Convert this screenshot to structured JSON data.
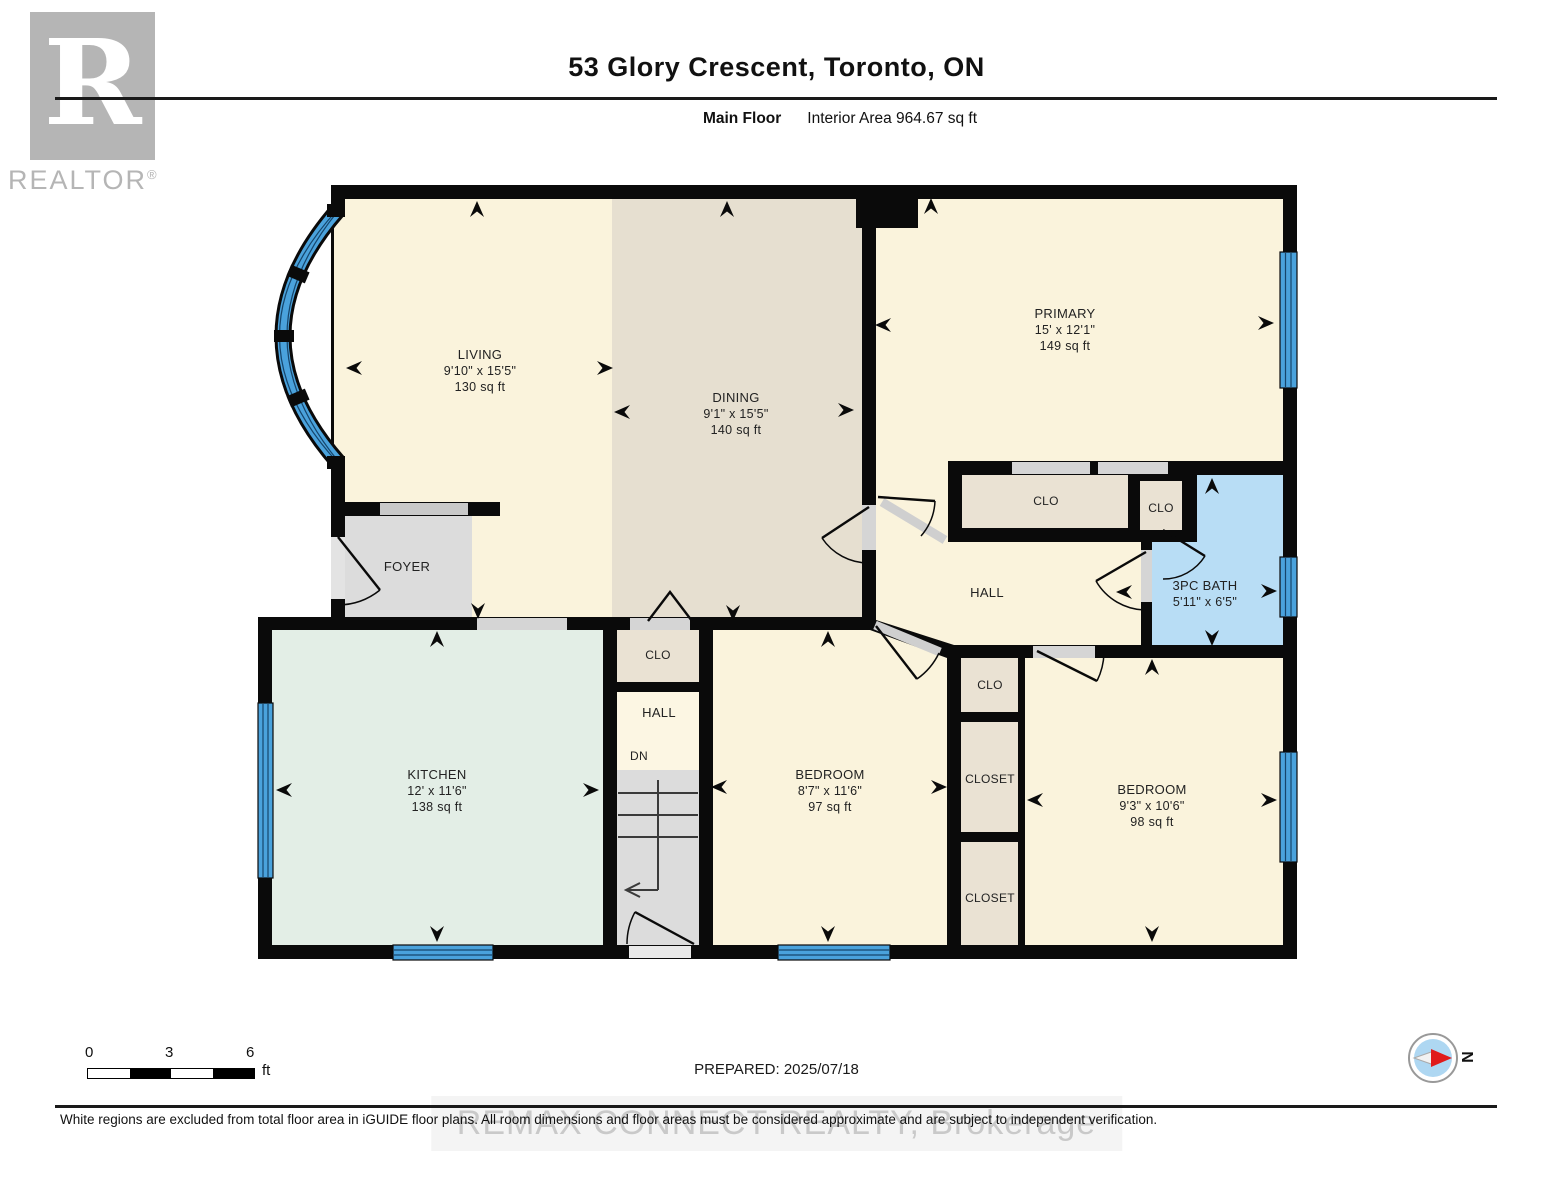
{
  "header": {
    "title": "53 Glory Crescent, Toronto, ON",
    "floor_label": "Main Floor",
    "area_label": "Interior Area 964.67 sq ft"
  },
  "branding": {
    "logo_letter": "R",
    "logo_text": "REALTOR",
    "logo_reg": "®",
    "watermark": "REMAX CONNECT REALTY, Brokerage"
  },
  "rooms": {
    "living": {
      "name": "LIVING",
      "dims": "9'10\" x 15'5\"",
      "area": "130 sq ft"
    },
    "dining": {
      "name": "DINING",
      "dims": "9'1\" x 15'5\"",
      "area": "140 sq ft"
    },
    "primary": {
      "name": "PRIMARY",
      "dims": "15' x 12'1\"",
      "area": "149 sq ft"
    },
    "bath": {
      "name": "3PC BATH",
      "dims": "5'11\" x 6'5\""
    },
    "kitchen": {
      "name": "KITCHEN",
      "dims": "12' x 11'6\"",
      "area": "138 sq ft"
    },
    "bedroom_middle": {
      "name": "BEDROOM",
      "dims": "8'7\" x 11'6\"",
      "area": "97 sq ft"
    },
    "bedroom_right": {
      "name": "BEDROOM",
      "dims": "9'3\" x 10'6\"",
      "area": "98 sq ft"
    },
    "foyer": {
      "name": "FOYER"
    },
    "hall_upper": {
      "name": "HALL"
    },
    "hall_lower": {
      "name": "HALL",
      "down_label": "DN"
    }
  },
  "labels": {
    "clo": "CLO",
    "closet": "CLOSET"
  },
  "footer": {
    "scale": {
      "tick0": "0",
      "tick1": "3",
      "tick2": "6",
      "unit": "ft"
    },
    "prepared": "PREPARED: 2025/07/18",
    "compass": "N",
    "disclaimer": "White regions are excluded from total floor area in iGUIDE floor plans. All room dimensions and floor areas must be considered approximate and are subject to independent verification."
  },
  "colors": {
    "wall": "#0a0a0a",
    "room_cream": "#faf3dc",
    "dining_tan": "#e6dfd0",
    "closet_beige": "#eae2d3",
    "kitchen_mint": "#e3eee6",
    "bath_blue": "#b8ddf5",
    "gray_floor": "#dcdcdc",
    "window_blue": "#4aa2dc"
  }
}
